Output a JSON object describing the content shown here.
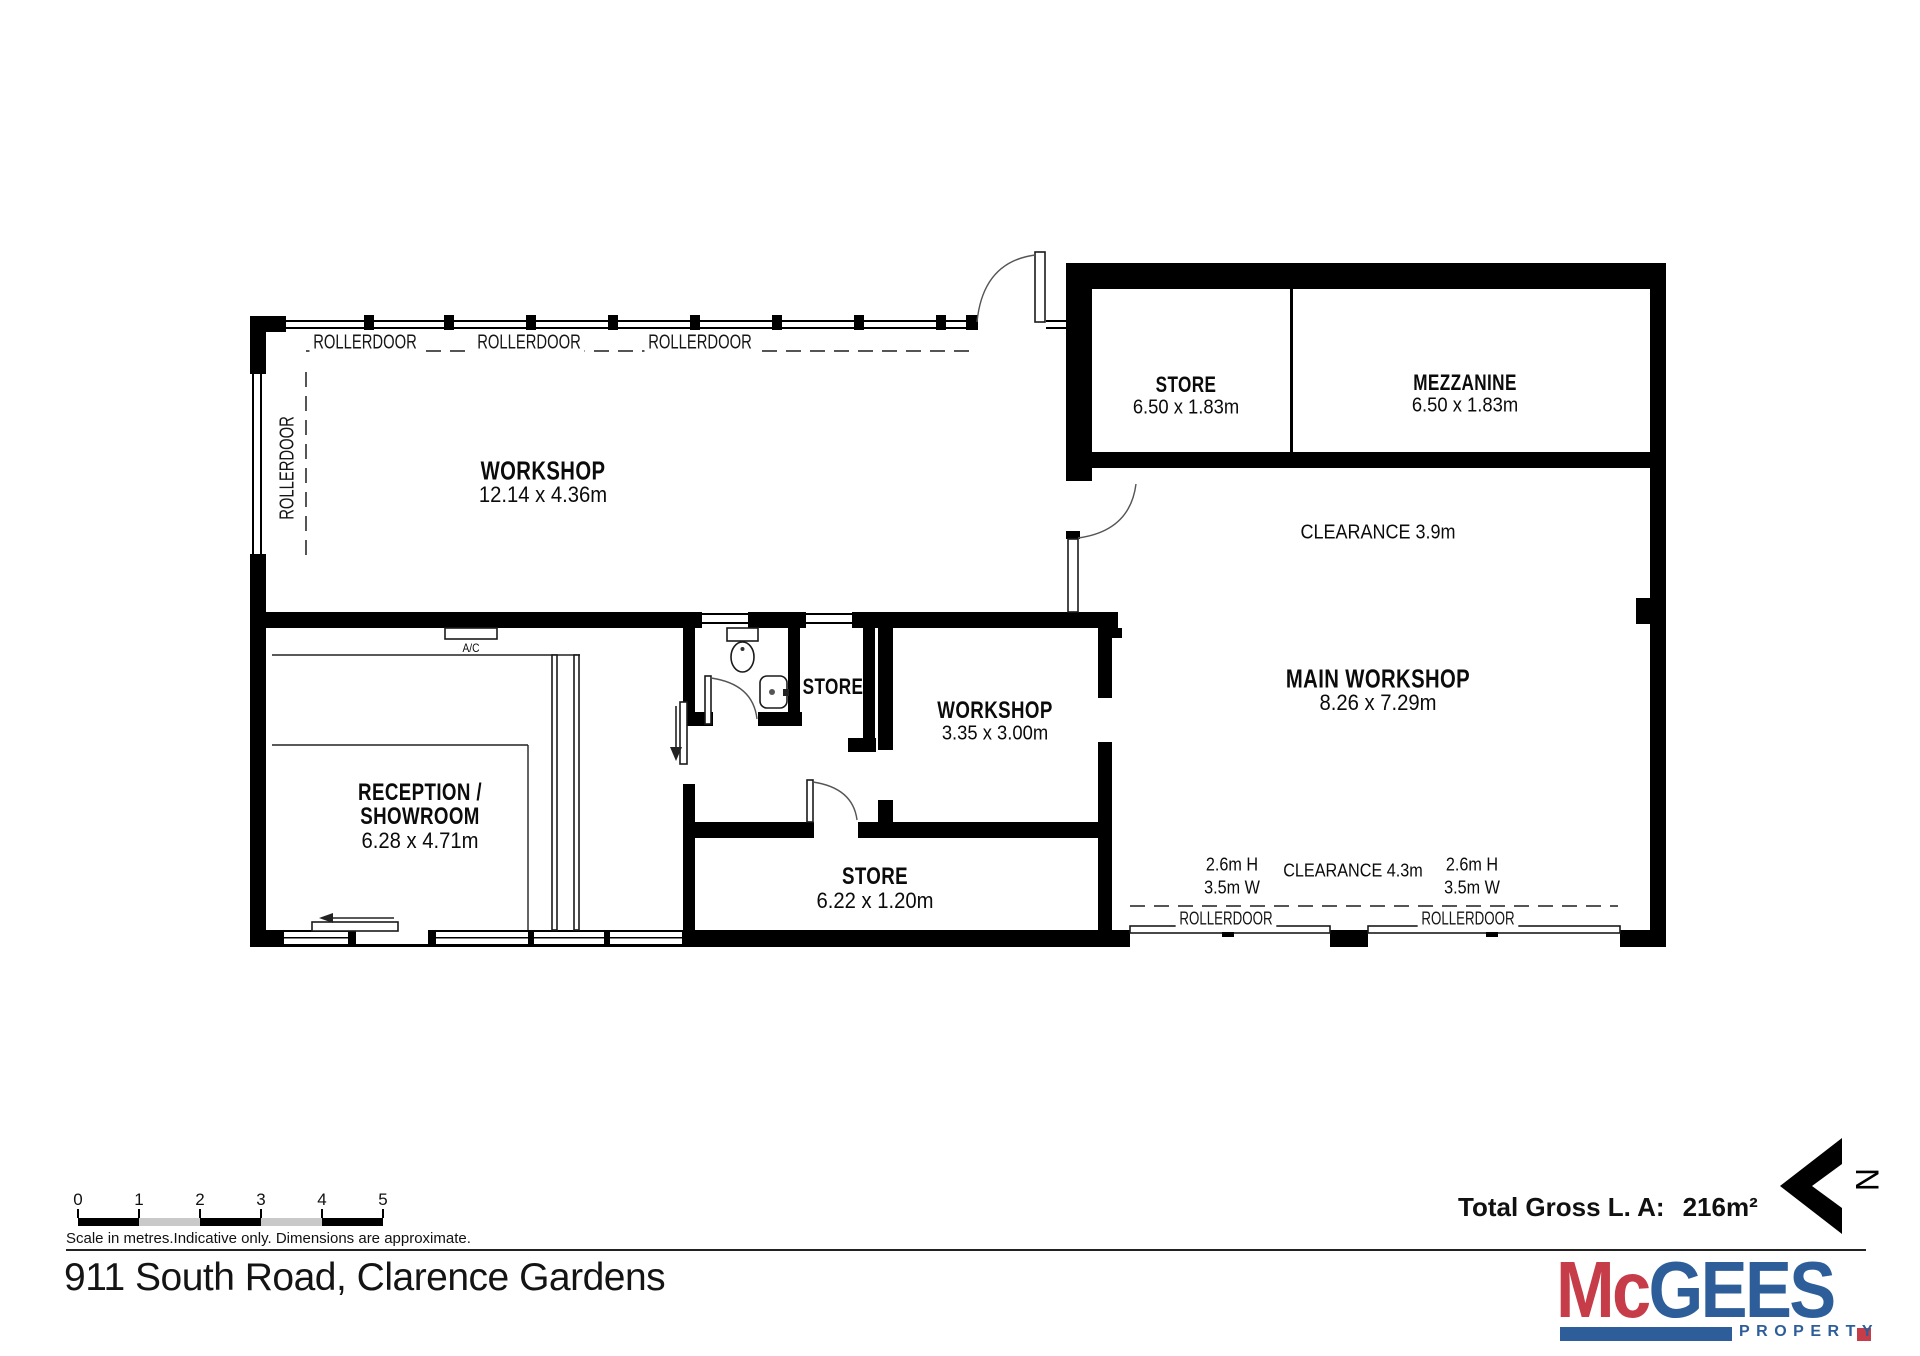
{
  "title": "911 South Road, Clarence Gardens",
  "north_indicator": "N",
  "scale_bar": {
    "ticks": [
      "0",
      "1",
      "2",
      "3",
      "4",
      "5"
    ],
    "caption": "Scale in metres.Indicative only. Dimensions are approximate."
  },
  "total_area": {
    "label": "Total Gross L. A:",
    "value": "216m²"
  },
  "logo": {
    "name_part1": "Mc",
    "name_part2": "GEES",
    "tagline": "PROPERTY",
    "red": "#C63C48",
    "blue": "#2D5E9A"
  },
  "plan": {
    "rooms": {
      "workshop_top": {
        "name": "WORKSHOP",
        "dims": "12.14 x 4.36m"
      },
      "store_top": {
        "name": "STORE",
        "dims": "6.50 x 1.83m"
      },
      "mezzanine": {
        "name": "MEZZANINE",
        "dims": "6.50 x 1.83m"
      },
      "main_workshop": {
        "name": "MAIN WORKSHOP",
        "dims": "8.26 x 7.29m"
      },
      "store_middle": {
        "name": "STORE"
      },
      "workshop_middle": {
        "name": "WORKSHOP",
        "dims": "3.35 x 3.00m"
      },
      "store_bottom": {
        "name": "STORE",
        "dims": "6.22 x 1.20m"
      },
      "reception": {
        "name_line1": "RECEPTION /",
        "name_line2": "SHOWROOM",
        "dims": "6.28 x 4.71m"
      }
    },
    "annotations": {
      "rollerdoor": "ROLLERDOOR",
      "clearance_upper": "CLEARANCE 3.9m",
      "clearance_lower": "CLEARANCE 4.3m",
      "door_height": "2.6m H",
      "door_width": "3.5m W",
      "ac": "A/C"
    }
  }
}
